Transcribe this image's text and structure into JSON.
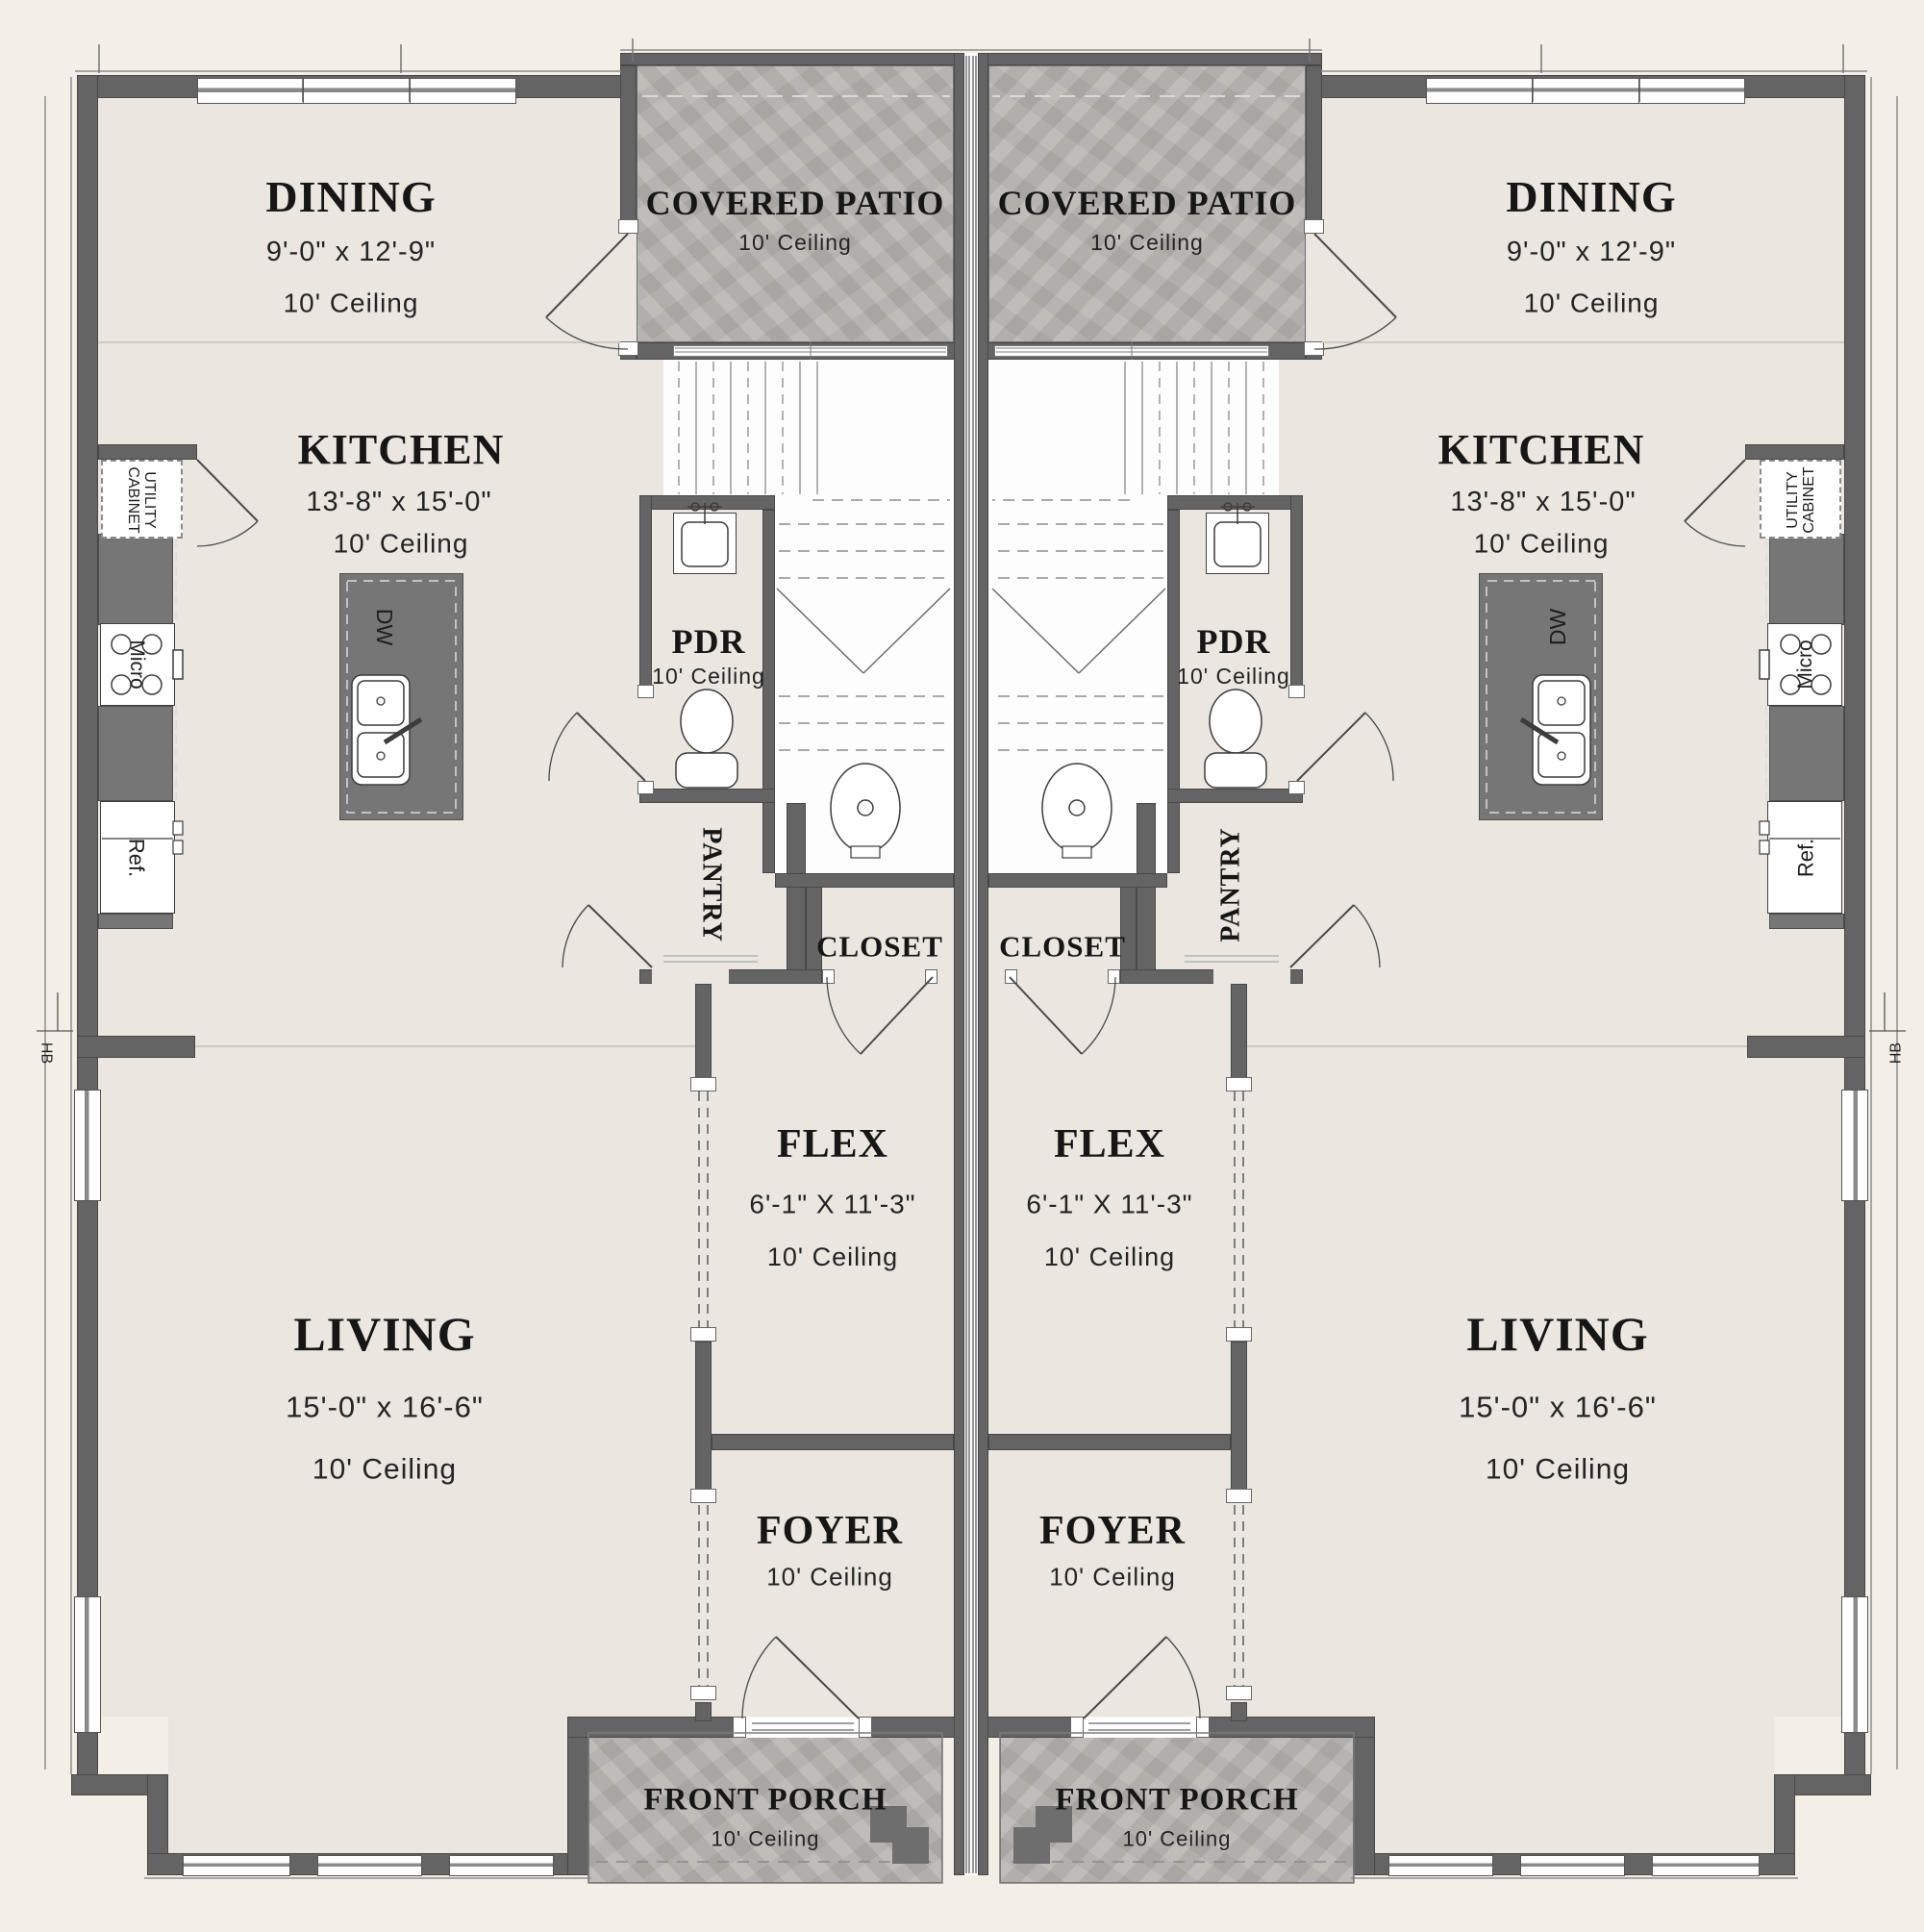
{
  "rooms": {
    "dining": {
      "title": "DINING",
      "dims": "9'-0\" x 12'-9\"",
      "ceiling": "10' Ceiling"
    },
    "kitchen": {
      "title": "KITCHEN",
      "dims": "13'-8\" x 15'-0\"",
      "ceiling": "10' Ceiling"
    },
    "covered_patio": {
      "title": "COVERED PATIO",
      "ceiling": "10' Ceiling"
    },
    "pdr": {
      "title": "PDR",
      "ceiling": "10' Ceiling"
    },
    "pantry": {
      "title": "PANTRY"
    },
    "closet": {
      "title": "CLOSET"
    },
    "flex": {
      "title": "FLEX",
      "dims": "6'-1\" X 11'-3\"",
      "ceiling": "10' Ceiling"
    },
    "living": {
      "title": "LIVING",
      "dims": "15'-0\" x 16'-6\"",
      "ceiling": "10' Ceiling"
    },
    "foyer": {
      "title": "FOYER",
      "ceiling": "10' Ceiling"
    },
    "front_porch": {
      "title": "FRONT PORCH",
      "ceiling": "10' Ceiling"
    }
  },
  "fixtures": {
    "dishwasher": "DW",
    "microwave": "Micro",
    "refrigerator": "Ref.",
    "utility_cabinet": "UTILITY CABINET",
    "hose_bib": "HB"
  },
  "colors": {
    "wall": "#646464",
    "floor": "#ebe6df",
    "concrete": "#b6b4b1",
    "island": "#767676",
    "page": "#f3efe7",
    "line": "#3c3c3c"
  }
}
